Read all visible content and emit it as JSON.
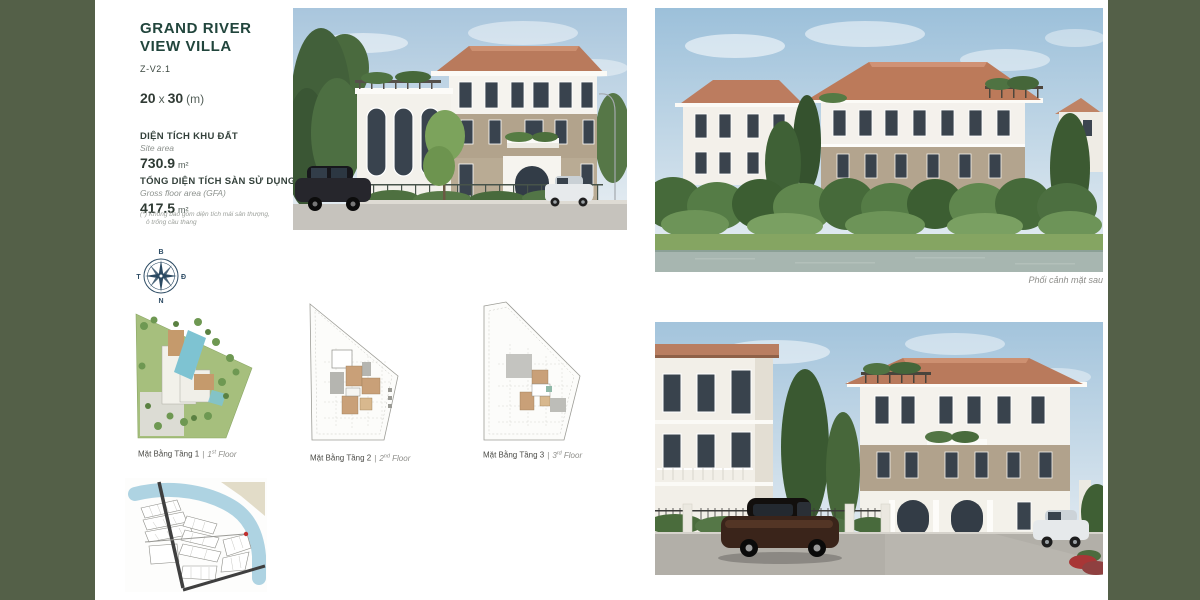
{
  "header": {
    "title_line1": "GRAND RIVER",
    "title_line2": "VIEW VILLA",
    "model_code": "Z-V2.1",
    "lot_width": "20",
    "lot_times": "x",
    "lot_depth": "30",
    "lot_unit": "(m)"
  },
  "specs": {
    "site_area": {
      "label_vi": "DIỆN TÍCH KHU ĐẤT",
      "label_en": "Site area",
      "value": "730.9",
      "unit": "m²"
    },
    "gfa": {
      "label_vi": "TỔNG DIỆN TÍCH SÀN SỬ DỤNG",
      "label_en": "Gross floor area (GFA)",
      "value": "417.5",
      "unit": "m²"
    },
    "footnote_line1": "(*) Không bao gồm diện tích mái sân thượng,",
    "footnote_line2": "ô trống cầu thang"
  },
  "compass": {
    "north": "B",
    "east": "Đ",
    "south": "N",
    "west": "T"
  },
  "floor_plans": [
    {
      "vi": "Mặt Bằng Tầng 1",
      "sep": "|",
      "num": "1",
      "ord": "st",
      "word": "Floor"
    },
    {
      "vi": "Mặt Bằng Tầng 2",
      "sep": "|",
      "num": "2",
      "ord": "nd",
      "word": "Floor"
    },
    {
      "vi": "Mặt Bằng Tầng 3",
      "sep": "|",
      "num": "3",
      "ord": "rd",
      "word": "Floor"
    }
  ],
  "captions": {
    "rear_perspective": "Phối cảnh mặt sau"
  },
  "colors": {
    "side_bar_green": "#546048",
    "title_green": "#21453c",
    "roof_terracotta": "#bb7a5c",
    "wall_taupe": "#b3a48e",
    "pool_blue": "#7ec3d2",
    "map_water_blue": "#aed3e2",
    "marker_red": "#c03030"
  }
}
